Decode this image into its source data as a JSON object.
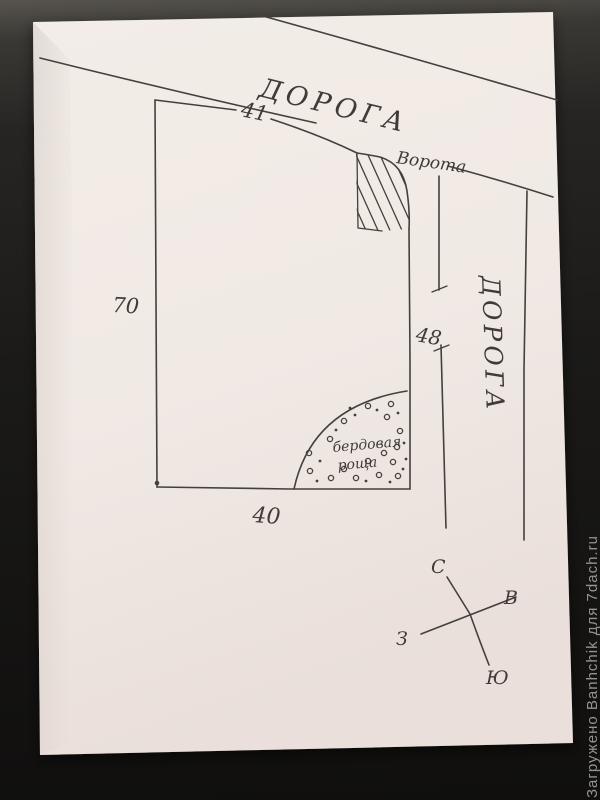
{
  "photo": {
    "watermark": "Загружено Banhchik для 7dach.ru"
  },
  "plan": {
    "top_road_label": "ДОРОГА",
    "right_road_label": "ДОРОГА",
    "gate_label": "Ворота",
    "grove_label": {
      "line1": "бердовая",
      "line2": "роща"
    },
    "dimensions": {
      "top_width": "41",
      "left_height": "70",
      "right_road_length": "48",
      "bottom_width": "40"
    },
    "compass": {
      "north": "С",
      "east": "В",
      "west": "З",
      "south": "Ю"
    },
    "colors": {
      "ink": "#45403b",
      "paper": "#f1eae5",
      "desk": "#1b1a18",
      "watermark": "#93948f"
    }
  }
}
